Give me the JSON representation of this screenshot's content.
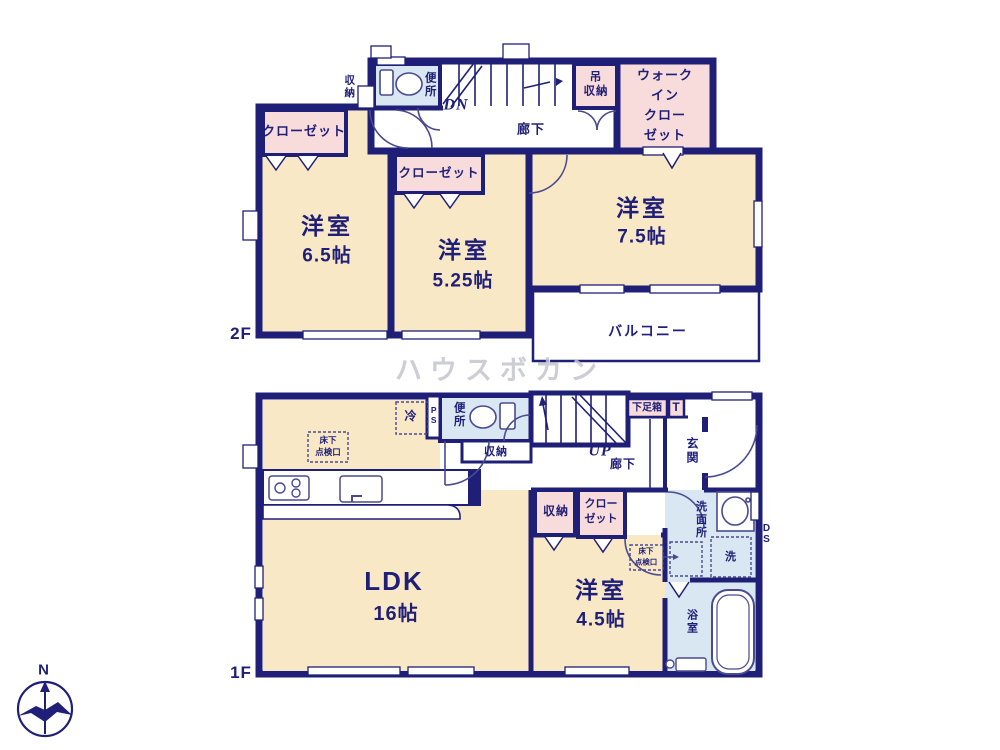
{
  "colors": {
    "wall": "#1f1f78",
    "room_fill": "#f8e8c6",
    "closet_fill": "#f8dbdb",
    "wet_fill": "#d9e7f3",
    "line_light": "#4a4a90",
    "watermark_gray": "#c5c5ce"
  },
  "watermark": "ハウスボカン",
  "compass": {
    "north": "N"
  },
  "floor2": {
    "label": "2F",
    "closet_west": "クローゼット",
    "closet_middle": "クローゼット",
    "room_west": {
      "name": "洋室",
      "size": "6.5帖"
    },
    "room_middle": {
      "name": "洋室",
      "size": "5.25帖"
    },
    "room_east": {
      "name": "洋室",
      "size": "7.5帖"
    },
    "storage": "収納",
    "toilet": "便所",
    "stairs": "DN",
    "hallway": "廊下",
    "hanging_storage": "吊\n収納",
    "walk_in_closet": "ウォーク\nイン\nクロー\nゼット",
    "balcony": "バルコニー"
  },
  "floor1": {
    "label": "1F",
    "refrigerator": "冷",
    "pipe_space": "PS",
    "toilet": "便所",
    "hall_storage": "収納",
    "stairs": "UP",
    "hallway": "廊下",
    "shoe_box": "下足箱",
    "t_box": "T",
    "entrance": "玄関",
    "floor_hatch_kitchen": "床下\n点検口",
    "ldk": {
      "name": "LDK",
      "size": "16帖"
    },
    "storage": "収納",
    "closet": "クロー\nゼット",
    "room": {
      "name": "洋室",
      "size": "4.5帖"
    },
    "floor_hatch_wash": "床下\n点検口",
    "washroom": "洗面所",
    "washer": "洗",
    "duct_space": "DS",
    "bathroom": "浴室"
  }
}
